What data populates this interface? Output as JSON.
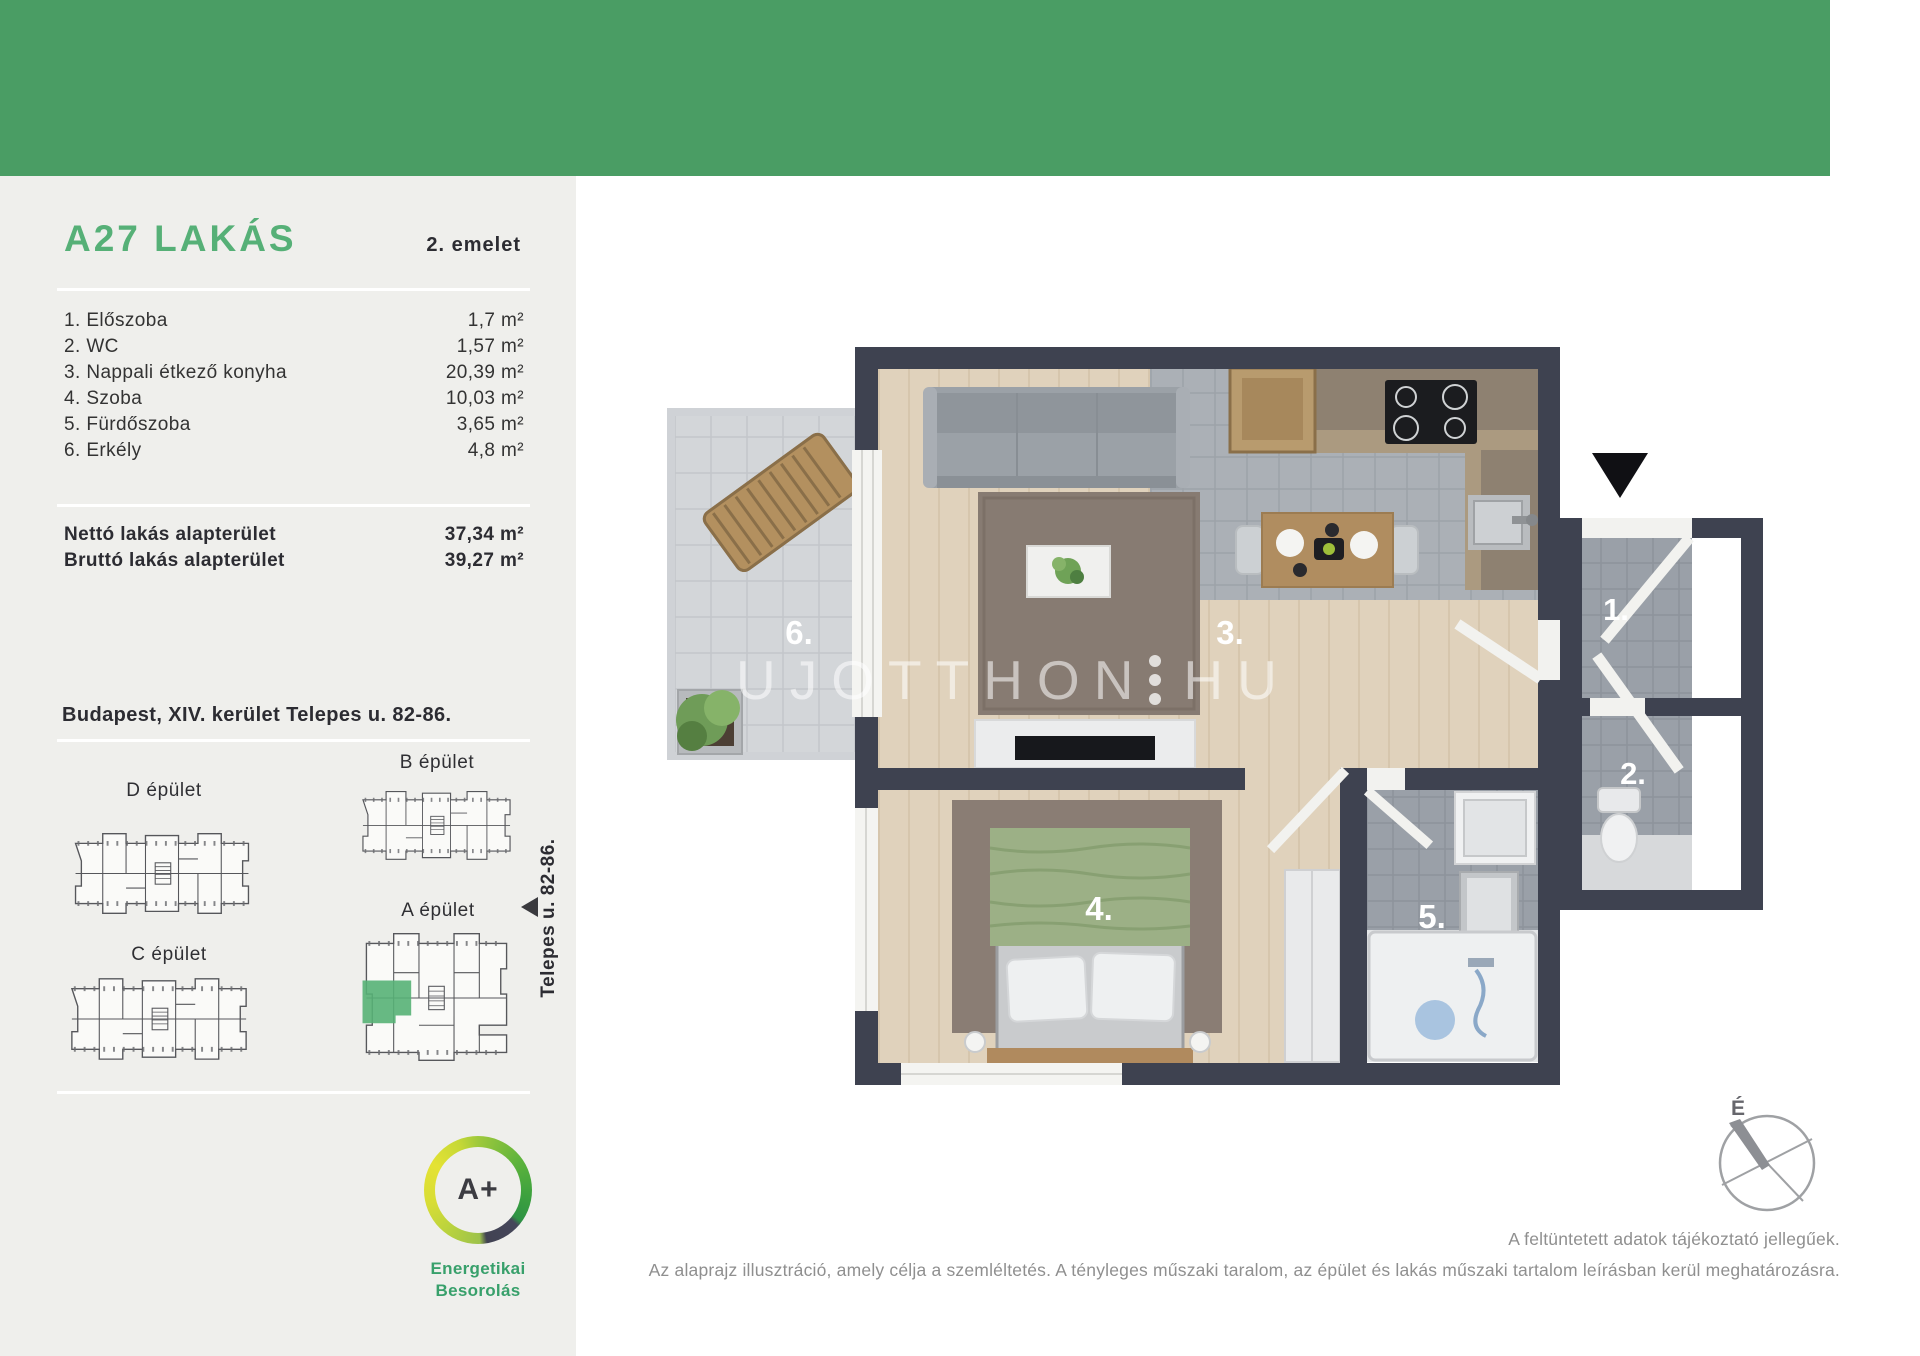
{
  "header": {
    "title": "A27 LAKÁS",
    "floor": "2. emelet"
  },
  "rooms": [
    {
      "name": "1. Előszoba",
      "area": "1,7 m²"
    },
    {
      "name": "2. WC",
      "area": "1,57 m²"
    },
    {
      "name": "3. Nappali étkező konyha",
      "area": "20,39 m²"
    },
    {
      "name": "4. Szoba",
      "area": "10,03 m²"
    },
    {
      "name": "5. Fürdőszoba",
      "area": "3,65 m²"
    },
    {
      "name": "6. Erkély",
      "area": "4,8 m²"
    }
  ],
  "totals": [
    {
      "label": "Nettó lakás alapterület",
      "value": "37,34 m²"
    },
    {
      "label": "Bruttó lakás alapterület",
      "value": "39,27 m²"
    }
  ],
  "address": "Budapest, XIV. kerület Telepes u. 82-86.",
  "buildings": {
    "d": "D épület",
    "b": "B épület",
    "c": "C épület",
    "a": "A épület",
    "street": "Telepes u. 82-86."
  },
  "energy": {
    "rating": "A+",
    "label_line1": "Energetikai",
    "label_line2": "Besorolás"
  },
  "plan": {
    "room_labels": [
      "1.",
      "2.",
      "3.",
      "4.",
      "5.",
      "6."
    ],
    "compass_label": "É"
  },
  "watermark": {
    "left": "UJOTTHON",
    "right": "HU"
  },
  "disclaimer": {
    "line1": "A feltüntetett adatok tájékoztató jellegűek.",
    "line2": "Az alaprajz illusztráció, amely célja a szemléltetés. A tényleges műszaki taralom, az épület és lakás műszaki tartalom leírásban kerül meghatározásra."
  },
  "colors": {
    "topbar_green": "#4a9d64",
    "title_green": "#56b077",
    "energy_label_green": "#38a06b",
    "highlight_green": "#57b176",
    "wall_dark": "#3e4250",
    "sidebar_bg": "#efefec"
  }
}
